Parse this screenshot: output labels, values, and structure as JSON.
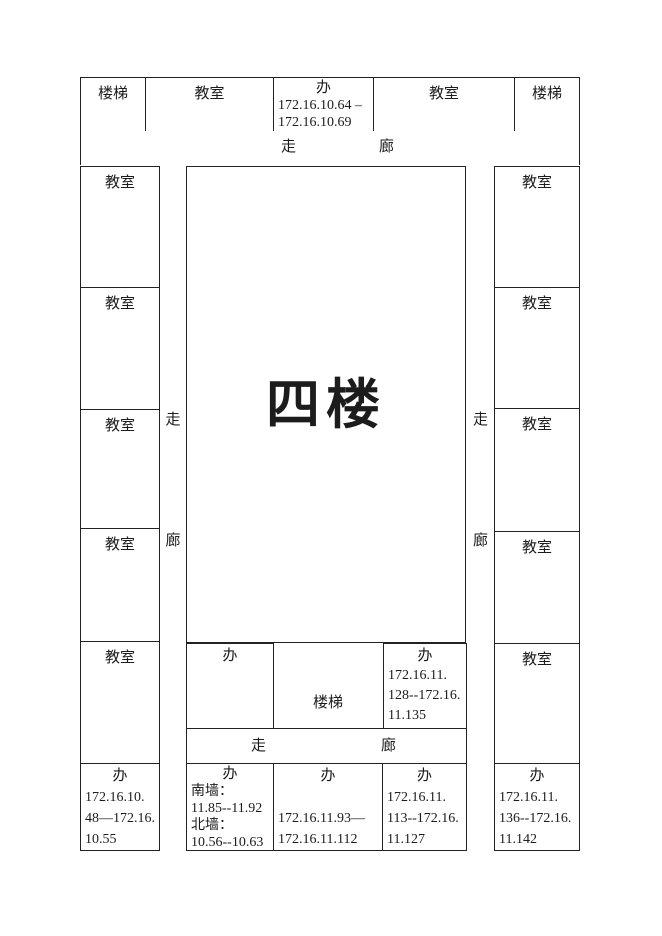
{
  "colors": {
    "background": "#ffffff",
    "line": "#222222",
    "text": "#1c1c1c"
  },
  "title": "四楼",
  "labels": {
    "classroom": "教室",
    "stairs": "楼梯",
    "walk": "走",
    "hall": "廊"
  },
  "top_row": {
    "stairs_left": "楼梯",
    "classroom_left": "教室",
    "office": {
      "label": "办",
      "lines": [
        "172.16.10.64 –",
        "172.16.10.69"
      ]
    },
    "classroom_right": "教室",
    "stairs_right": "楼梯"
  },
  "left_wing": {
    "classrooms": [
      "教室",
      "教室",
      "教室",
      "教室",
      "教室"
    ]
  },
  "right_wing": {
    "classrooms": [
      "教室",
      "教室",
      "教室",
      "教室",
      "教室"
    ]
  },
  "inner": {
    "office_left": {
      "label": "办"
    },
    "stairs": "楼梯",
    "office_right": {
      "label": "办",
      "lines": [
        "172.16.11.",
        "128--172.16.",
        "11.135"
      ]
    }
  },
  "bottom_row": {
    "office_1": {
      "label": "办",
      "lines": [
        "172.16.10.",
        "48—172.16.",
        "10.55"
      ]
    },
    "office_2": {
      "label": "办",
      "lines": [
        "南墙：",
        "11.85--11.92",
        "北墙：",
        "10.56--10.63"
      ]
    },
    "office_3": {
      "label": "办",
      "lines": [
        "",
        "172.16.11.93—",
        "172.16.11.112"
      ]
    },
    "office_4": {
      "label": "办",
      "lines": [
        "172.16.11.",
        "113--172.16.",
        "11.127"
      ]
    },
    "office_5": {
      "label": "办",
      "lines": [
        "172.16.11.",
        "136--172.16.",
        "11.142"
      ]
    }
  }
}
